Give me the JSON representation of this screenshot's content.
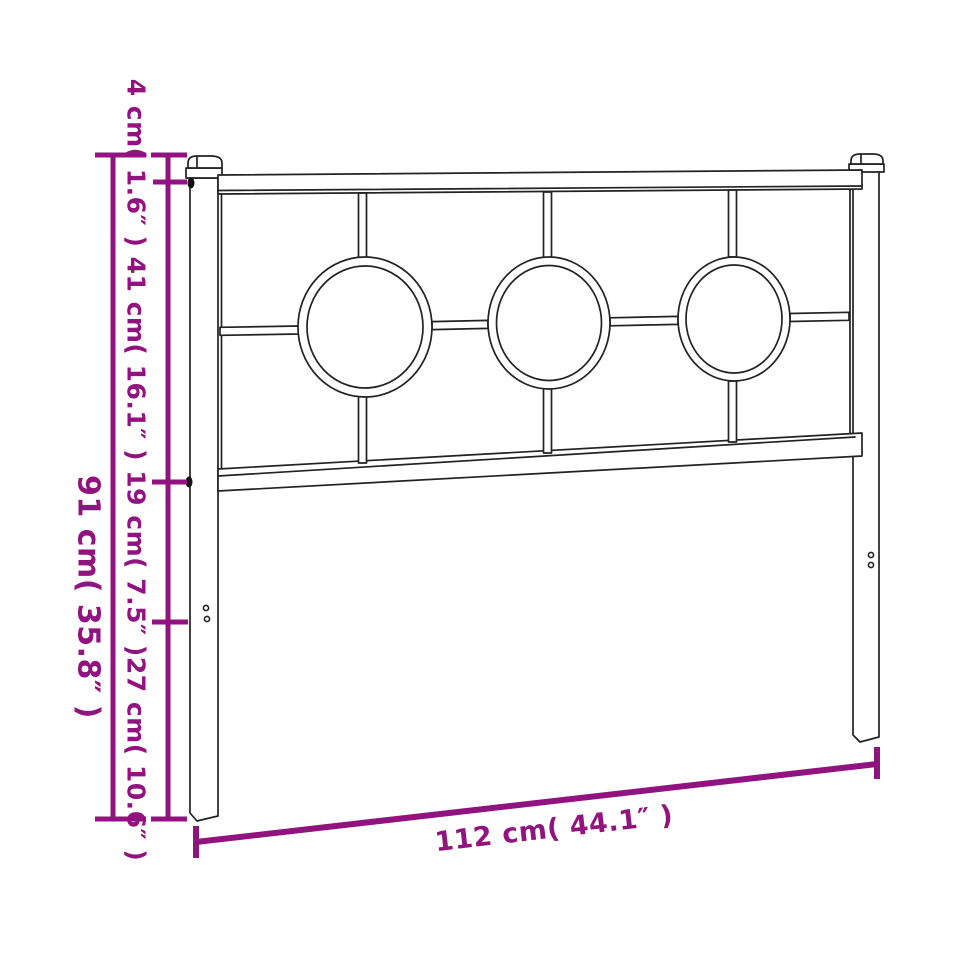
{
  "diagram": {
    "type": "product-dimension-diagram",
    "subject": "metal-headboard-line-drawing",
    "colors": {
      "dimension": "#91137F",
      "line_art": "#222222",
      "background": "#ffffff"
    },
    "labels": {
      "height_total": "91 cm( 35.8″ )",
      "height_segments": "4 cm( 1.6″ ) 41 cm( 16.1″ ) 19 cm( 7.5″ )27 cm( 10.6″ )",
      "width": "112 cm( 44.1″ )"
    },
    "measurements": {
      "total_height": {
        "cm": 91,
        "inch": 35.8
      },
      "height_segments": [
        {
          "cm": 4,
          "inch": 1.6
        },
        {
          "cm": 41,
          "inch": 16.1
        },
        {
          "cm": 19,
          "inch": 7.5
        },
        {
          "cm": 27,
          "inch": 10.6
        }
      ],
      "width": {
        "cm": 112,
        "inch": 44.1
      }
    },
    "features": {
      "decorative_rings": 3,
      "posts": 2,
      "mounting_holes_per_leg": 2
    }
  }
}
